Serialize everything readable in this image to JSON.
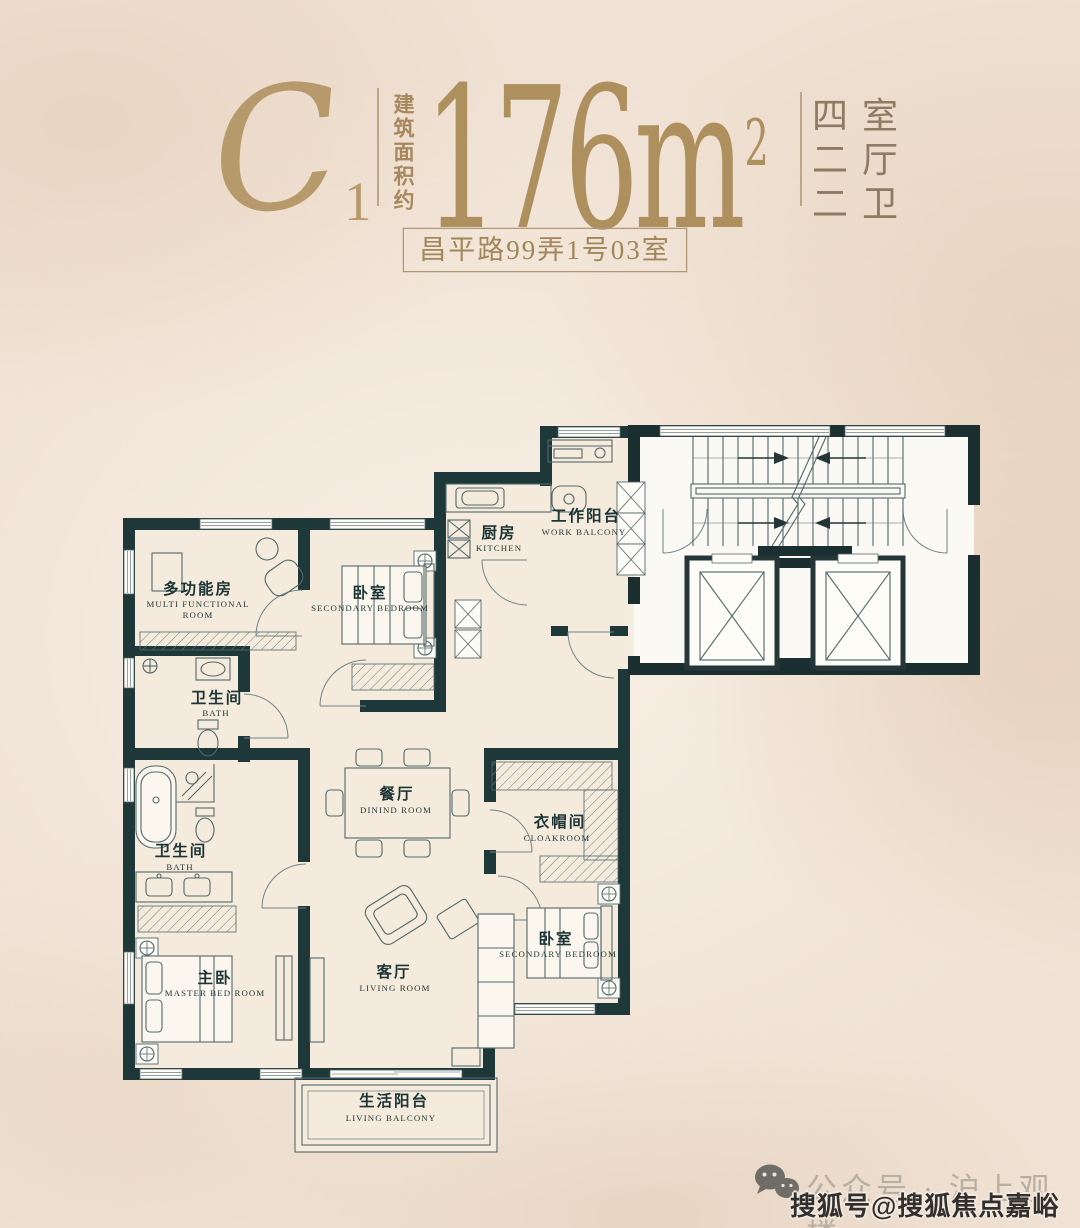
{
  "header": {
    "plan_code": "C",
    "plan_code_sub": "1",
    "area_label": "建筑面积约",
    "area_number": "176",
    "area_unit": "m",
    "area_sup": "2",
    "specs": [
      "四室",
      "二厅",
      "二卫"
    ],
    "address": "昌平路99弄1号03室"
  },
  "rooms": {
    "multi": {
      "zh": "多功能房",
      "en": "MULTI FUNCTIONAL",
      "en2": "ROOM"
    },
    "bedroom_top": {
      "zh": "卧室",
      "en": "SECONDARY BEDROOM"
    },
    "kitchen": {
      "zh": "厨房",
      "en": "KITCHEN"
    },
    "work_balcony": {
      "zh": "工作阳台",
      "en": "WORK BALCONY"
    },
    "bath_upper": {
      "zh": "卫生间",
      "en": "BATH"
    },
    "dining": {
      "zh": "餐厅",
      "en": "DININD ROOM"
    },
    "cloakroom": {
      "zh": "衣帽间",
      "en": "CLOAKROOM"
    },
    "bath_master": {
      "zh": "卫生间",
      "en": "BATH"
    },
    "master_bedroom": {
      "zh": "主卧",
      "en": "MASTER BED ROOM"
    },
    "living": {
      "zh": "客厅",
      "en": "LIVING ROOM"
    },
    "bedroom_right": {
      "zh": "卧室",
      "en": "SECONDARY BEDROOM"
    },
    "living_balcony": {
      "zh": "生活阳台",
      "en": "LIVING BALCONY"
    }
  },
  "footer": {
    "account_text": "公众号 · 沪上观楼",
    "watermark": "搜狐号@搜狐焦点嘉峪关站"
  },
  "colors": {
    "accent_gold": "#ae905f",
    "wall_teal": "#1e3738",
    "background": "#efe1d3"
  }
}
